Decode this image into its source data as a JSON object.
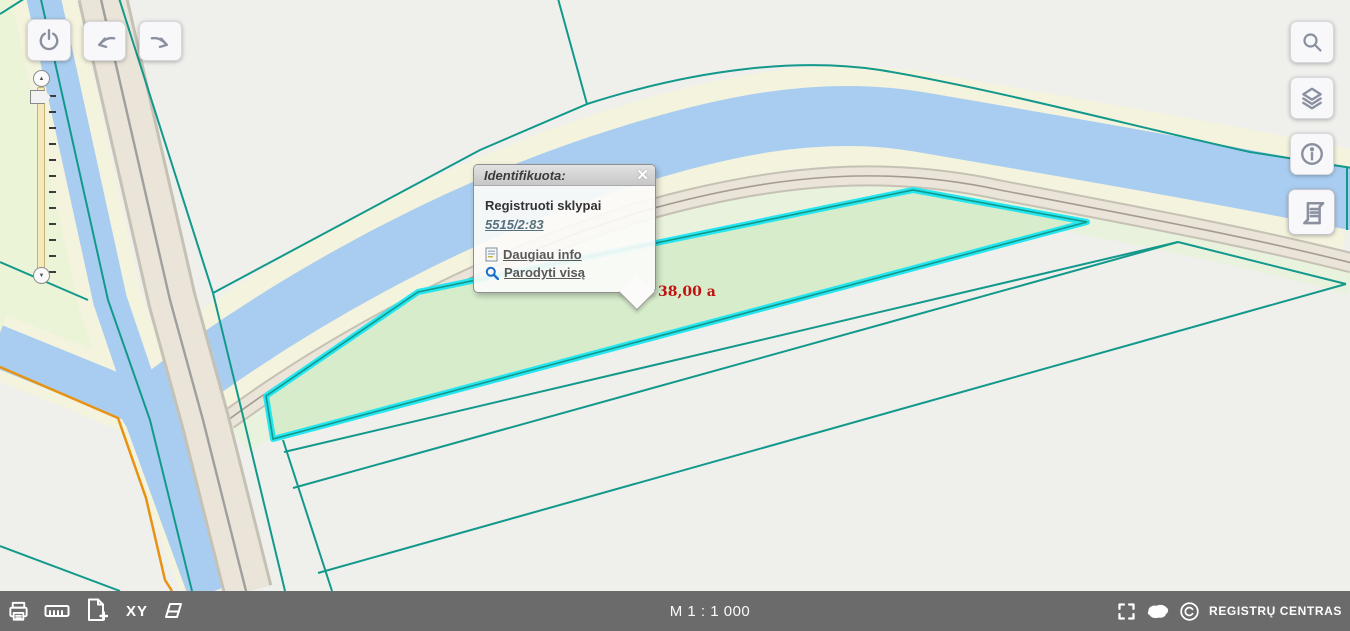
{
  "popup": {
    "title": "Identifikuota:",
    "close": "✕",
    "result_layer": "Registruoti sklypai",
    "parcel_code": "5515/2:83",
    "link_more": "Daugiau info",
    "link_show_all": "Parodyti visą"
  },
  "map": {
    "area_label": "38,00 a",
    "scale_label": "M 1 : 1 000"
  },
  "footer": {
    "xy_label": "XY",
    "brand": "REGISTRŲ CENTRAS"
  },
  "colors": {
    "water": "#a9cdf0",
    "shore": "#f4f3dd",
    "boundary_teal": "#12998b",
    "highlight_cyan": "#25e6f0",
    "parcel_fill": "#d6ecca",
    "orange_line": "#e89212",
    "area_label_red": "#c11212",
    "bottom_bar": "#6b6b6b",
    "background": "#efefec",
    "left_green": "#ecf4d7"
  }
}
